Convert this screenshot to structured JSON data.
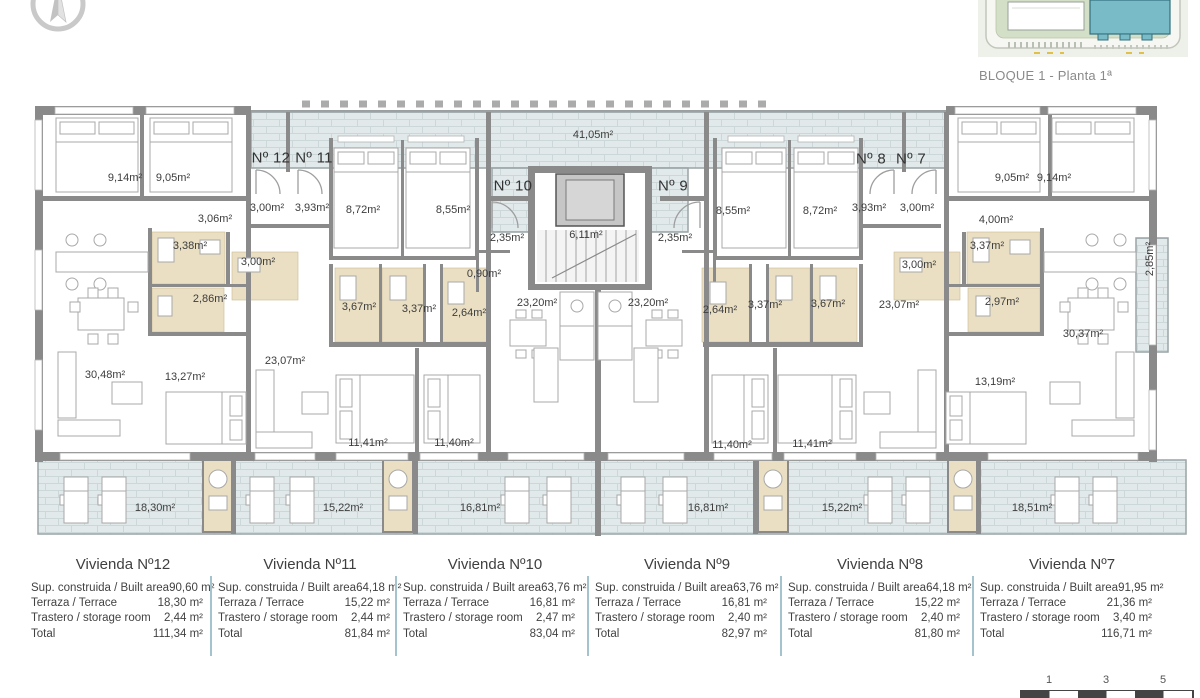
{
  "header": {
    "caption": "BLOQUE 1 - Planta 1ª"
  },
  "site_plan": {
    "highlighted_block_color": "#79bcc8"
  },
  "plan": {
    "unit_labels": [
      "Nº 12",
      "Nº 11",
      "Nº 10",
      "Nº 9",
      "Nº 8",
      "Nº 7"
    ],
    "area_labels": [
      "41,05m²",
      "9,14m²",
      "9,05m²",
      "3,00m²",
      "3,93m²",
      "8,72m²",
      "8,55m²",
      "3,06m²",
      "2,35m²",
      "6,11m²",
      "2,35m²",
      "8,55m²",
      "8,72m²",
      "3,93m²",
      "3,00m²",
      "9,05m²",
      "9,14m²",
      "4,00m²",
      "3,38m²",
      "3,00m²",
      "0,90m²",
      "3,37m²",
      "3,00m²",
      "2,86m²",
      "3,67m²",
      "3,37m²",
      "2,64m²",
      "23,20m²",
      "23,20m²",
      "2,64m²",
      "3,37m²",
      "3,67m²",
      "23,07m²",
      "2,97m²",
      "23,07m²",
      "30,48m²",
      "13,27m²",
      "30,37m²",
      "13,19m²",
      "11,41m²",
      "11,40m²",
      "11,40m²",
      "11,41m²",
      "2,85m²",
      "18,30m²",
      "15,22m²",
      "16,81m²",
      "16,81m²",
      "15,22m²",
      "18,51m²"
    ]
  },
  "table": {
    "row_labels": [
      "Sup. construida / Built area",
      "Terraza / Terrace",
      "Trastero / storage room",
      "Total"
    ],
    "units": [
      {
        "title": "Vivienda Nº12",
        "values": [
          "90,60 m²",
          "18,30 m²",
          "2,44 m²",
          "111,34 m²"
        ]
      },
      {
        "title": "Vivienda Nº11",
        "values": [
          "64,18 m²",
          "15,22 m²",
          "2,44 m²",
          "81,84 m²"
        ]
      },
      {
        "title": "Vivienda Nº10",
        "values": [
          "63,76 m²",
          "16,81 m²",
          "2,47 m²",
          "83,04 m²"
        ]
      },
      {
        "title": "Vivienda Nº9",
        "values": [
          "63,76 m²",
          "16,81 m²",
          "2,40 m²",
          "82,97 m²"
        ]
      },
      {
        "title": "Vivienda Nº8",
        "values": [
          "64,18 m²",
          "15,22 m²",
          "2,40 m²",
          "81,80 m²"
        ]
      },
      {
        "title": "Vivienda Nº7",
        "values": [
          "91,95 m²",
          "21,36 m²",
          "3,40 m²",
          "116,71 m²"
        ]
      }
    ]
  },
  "scale_bar": {
    "ticks": [
      "1",
      "3",
      "5"
    ]
  },
  "colors": {
    "wall_gray": "#8a8a8a",
    "terrace_tile": "#e1e9ea",
    "bathroom_beige": "#eadfc3",
    "highlight_teal": "#79bcc8",
    "table_divider": "#a5c3cd"
  }
}
